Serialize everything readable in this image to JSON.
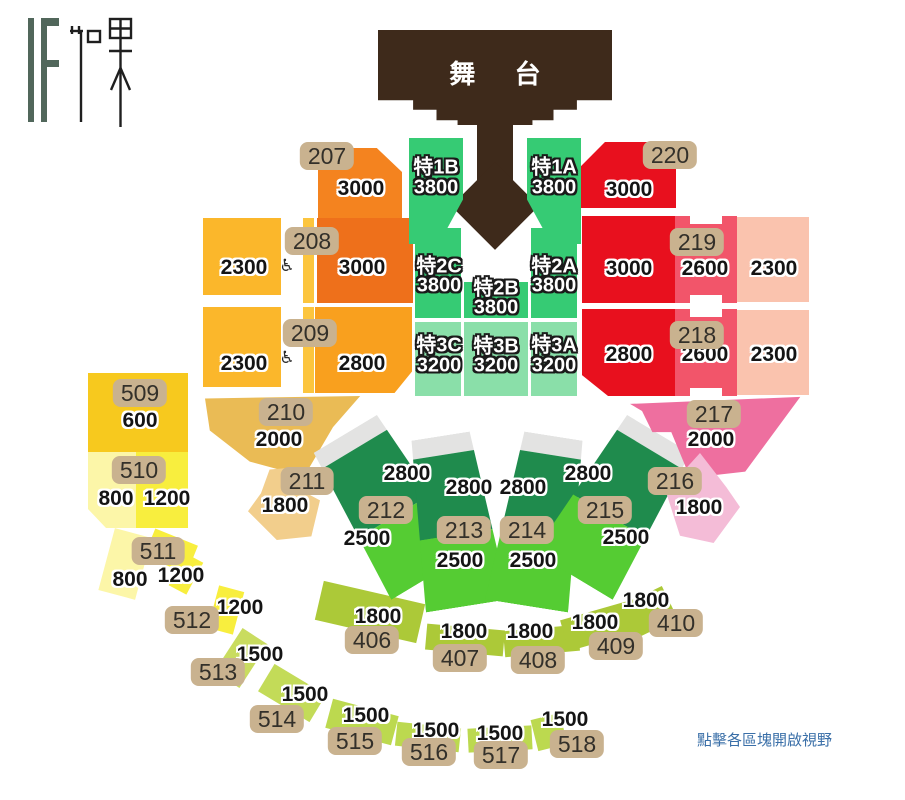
{
  "logo": {
    "text": "IF 如果"
  },
  "stage": {
    "label": "舞 台"
  },
  "caption": "點擊各區塊開啟視野",
  "palette": {
    "stage_brown": "#3E2A1B",
    "orange": "#F4831F",
    "orange_dark": "#EE701B",
    "orange_light": "#F9A01E",
    "golden": "#FBB72B",
    "gold_tan": "#EABB55",
    "tan_light": "#F2CE8C",
    "yellow": "#F7C91E",
    "yellow_pale": "#FCF6A8",
    "yellow_bright": "#F8EE3E",
    "yellow_green": "#C9DC5F",
    "green_arc": "#BCD94F",
    "olive": "#ACC938",
    "emerald": "#36CB74",
    "mint": "#8ADFA9",
    "fan_dark_green": "#1F8B4D",
    "fan_bright_green": "#55CC33",
    "fan_gray": "#E3E3E2",
    "red": "#E8101E",
    "red_pink": "#F2556A",
    "salmon": "#FAC3AE",
    "pink": "#EE6F9F",
    "pink_light": "#F4BCD7",
    "badge_tan": "#C9B28F",
    "caption_blue": "#3A6FA8"
  },
  "sections": {
    "s207": {
      "badge": "207",
      "price": "3000"
    },
    "s208": {
      "badge": "208",
      "price_main": "3000",
      "price_side": "2300",
      "wheelchair": "♿"
    },
    "s209": {
      "badge": "209",
      "price_main": "2800",
      "price_side": "2300",
      "wheelchair": "♿"
    },
    "s210": {
      "badge": "210",
      "price": "2000"
    },
    "s211": {
      "badge": "211",
      "price": "1800"
    },
    "s220": {
      "badge": "220",
      "price": "3000"
    },
    "s219": {
      "badge": "219",
      "price_inner": "3000",
      "price_mid": "2600",
      "price_outer": "2300"
    },
    "s218": {
      "badge": "218",
      "price_inner": "2800",
      "price_mid": "2600",
      "price_outer": "2300"
    },
    "s217": {
      "badge": "217",
      "price": "2000"
    },
    "s216": {
      "badge": "216",
      "price": "1800"
    },
    "t1b": {
      "name": "特1B",
      "price": "3800"
    },
    "t1a": {
      "name": "特1A",
      "price": "3800"
    },
    "t2c": {
      "name": "特2C",
      "price": "3800"
    },
    "t2b": {
      "name": "特2B",
      "price": "3800"
    },
    "t2a": {
      "name": "特2A",
      "price": "3800"
    },
    "t3c": {
      "name": "特3C",
      "price": "3200"
    },
    "t3b": {
      "name": "特3B",
      "price": "3200"
    },
    "t3a": {
      "name": "特3A",
      "price": "3200"
    },
    "s212": {
      "badge": "212",
      "price_upper": "2800",
      "price_lower": "2500"
    },
    "s213": {
      "badge": "213",
      "price_upper": "2800",
      "price_lower": "2500"
    },
    "s214": {
      "badge": "214",
      "price_upper": "2800",
      "price_lower": "2500"
    },
    "s215": {
      "badge": "215",
      "price_upper": "2800",
      "price_lower": "2500"
    },
    "s509": {
      "badge": "509",
      "price": "600"
    },
    "s510": {
      "badge": "510",
      "price_left": "800",
      "price_right": "1200"
    },
    "s511": {
      "badge": "511",
      "price_left": "800",
      "price_right": "1200"
    },
    "s512": {
      "badge": "512",
      "price": "1200"
    },
    "s513": {
      "badge": "513",
      "price": "1500"
    },
    "s514": {
      "badge": "514",
      "price": "1500"
    },
    "s515": {
      "badge": "515",
      "price": "1500"
    },
    "s516": {
      "badge": "516",
      "price": "1500"
    },
    "s517": {
      "badge": "517",
      "price": "1500"
    },
    "s518": {
      "badge": "518",
      "price": "1500"
    },
    "s406": {
      "badge": "406",
      "price": "1800"
    },
    "s407": {
      "badge": "407",
      "price": "1800"
    },
    "s408": {
      "badge": "408",
      "price": "1800"
    },
    "s409": {
      "badge": "409",
      "price": "1800"
    },
    "s410": {
      "badge": "410",
      "price": "1800"
    }
  }
}
